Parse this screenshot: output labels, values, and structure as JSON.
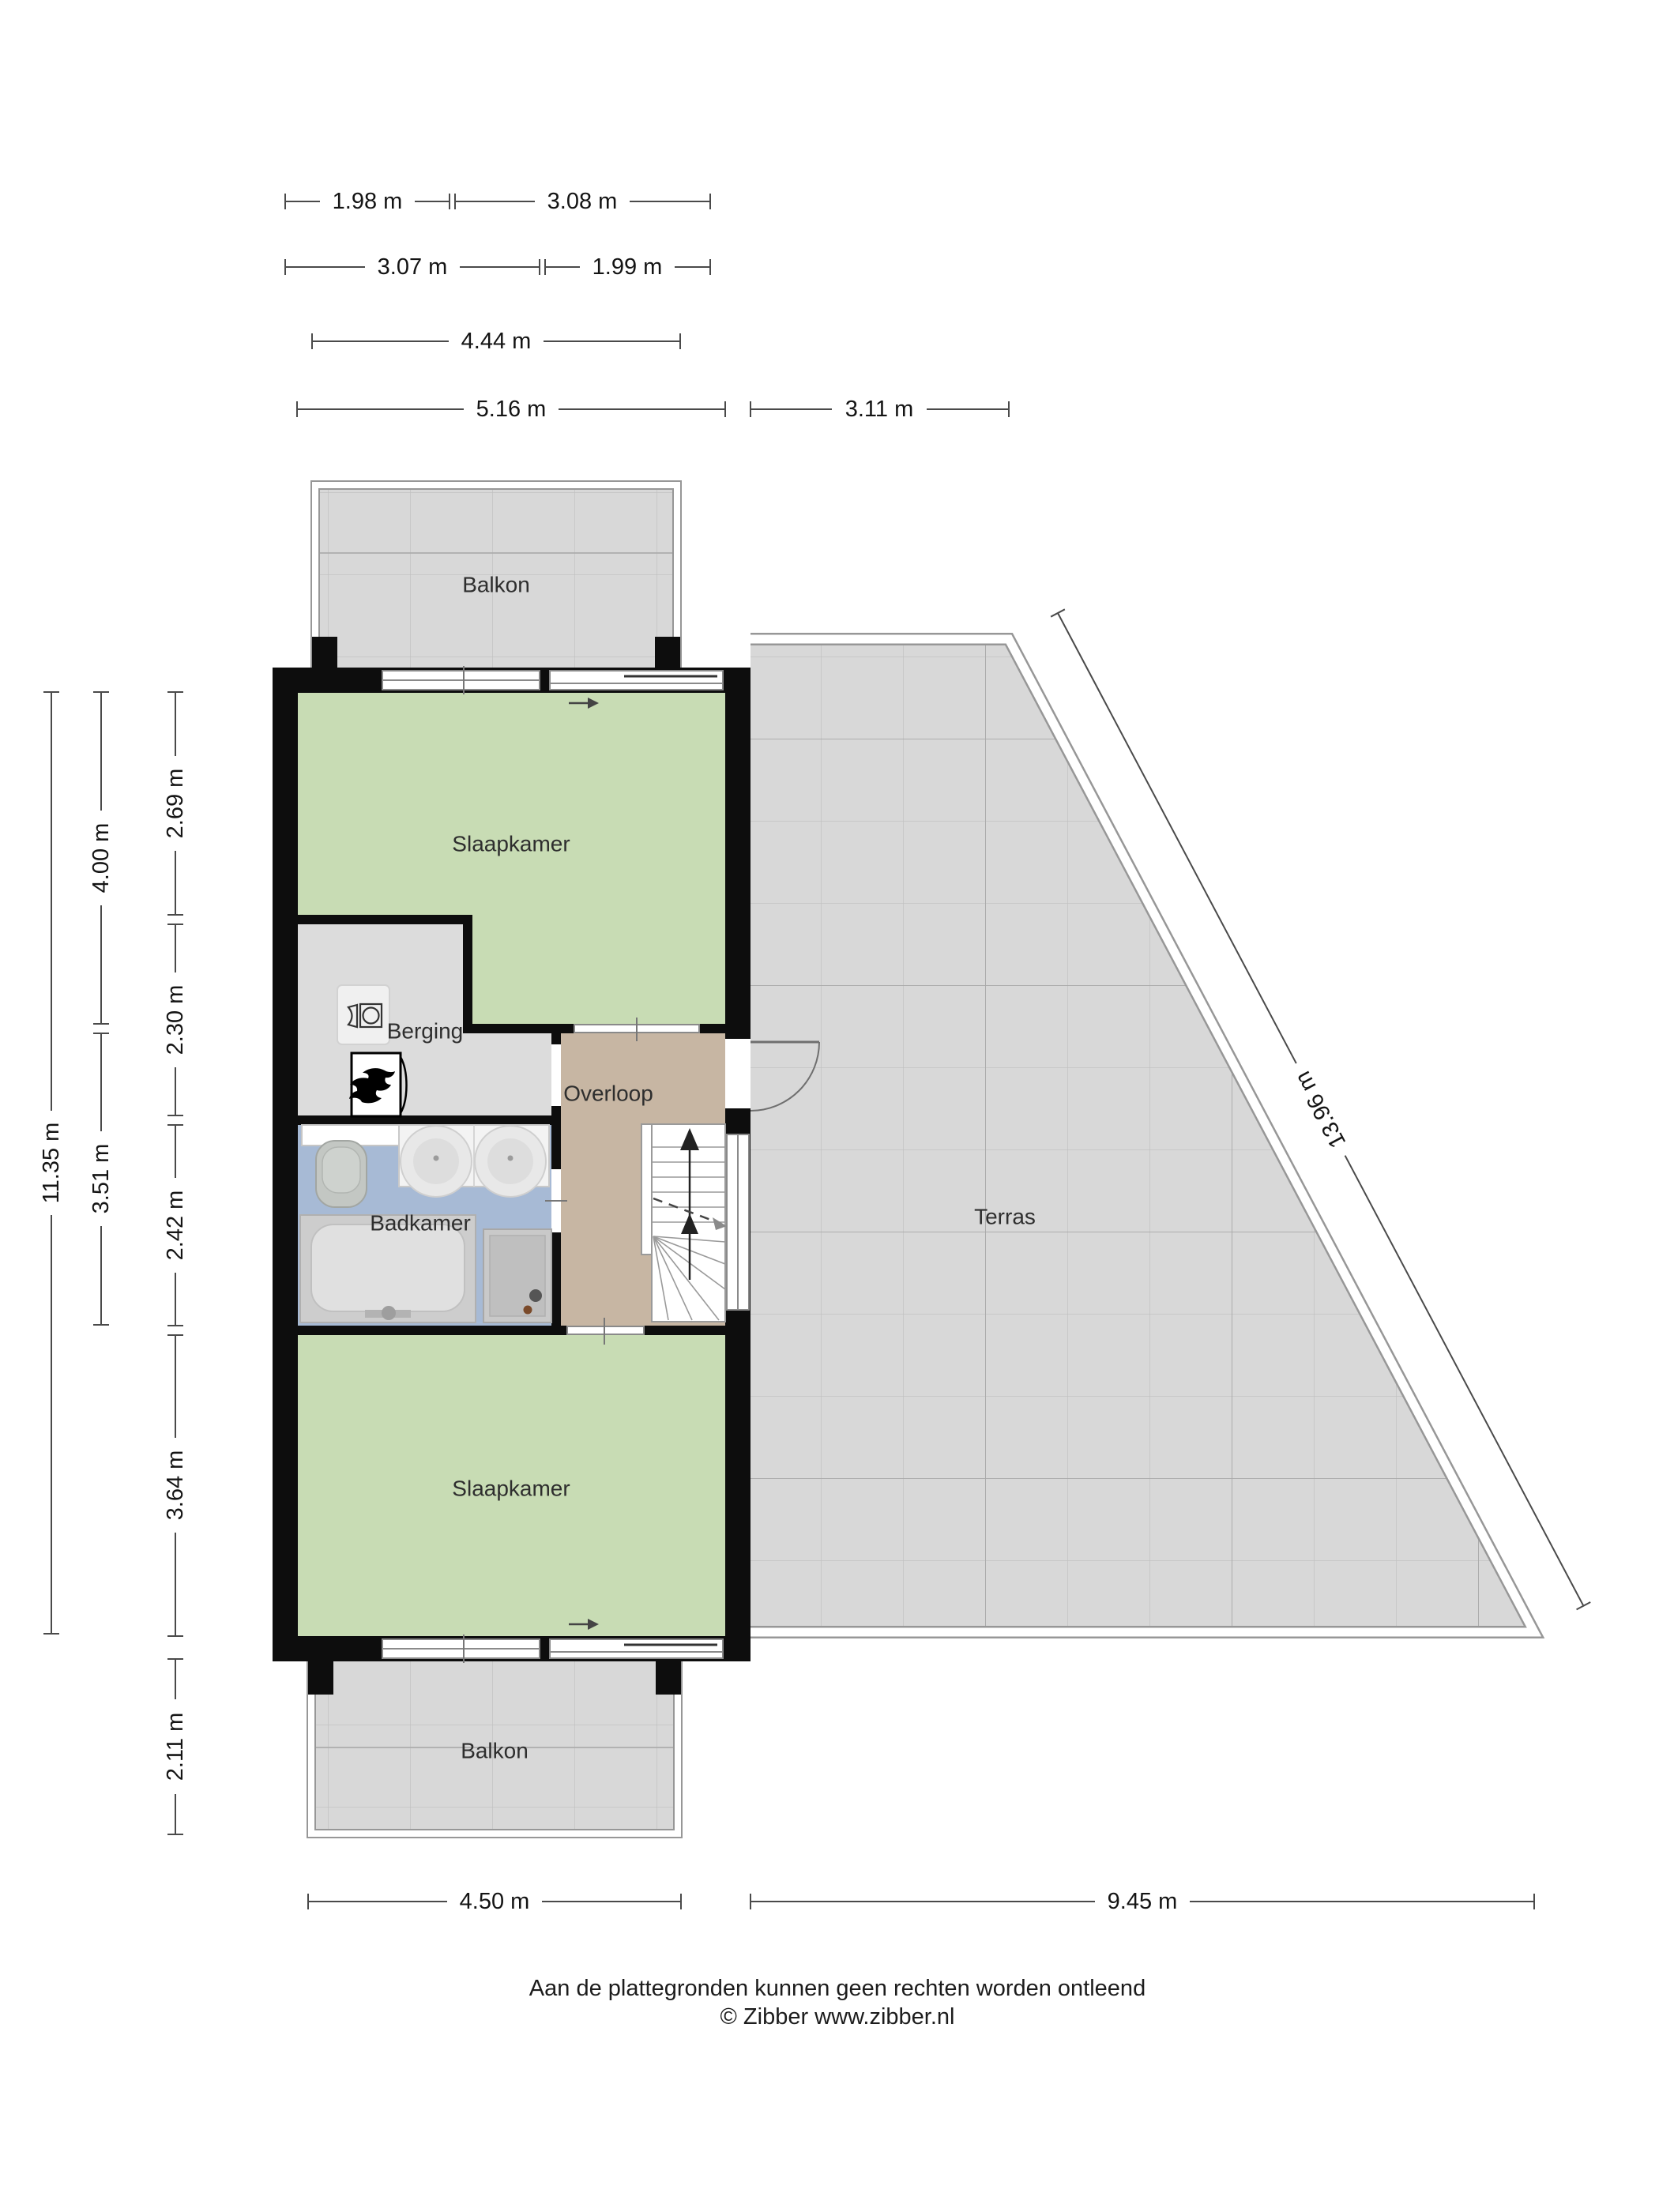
{
  "plan": {
    "type": "floor-plan",
    "floor": "verdieping (upper floor)",
    "language": "Dutch"
  },
  "rooms": {
    "balkon_top": "Balkon",
    "slaapkamer_top": "Slaapkamer",
    "berging": "Berging",
    "overloop": "Overloop",
    "badkamer": "Badkamer",
    "terras": "Terras",
    "slaapkamer_bottom": "Slaapkamer",
    "balkon_bottom": "Balkon"
  },
  "dimensions": {
    "top_row1_left": "1.98 m",
    "top_row1_right": "3.08 m",
    "top_row2_left": "3.07 m",
    "top_row2_right": "1.99 m",
    "top_row3": "4.44 m",
    "top_row4_left": "5.16 m",
    "top_row4_right": "3.11 m",
    "left_total": "11.35 m",
    "left_upper": "4.00 m",
    "left_lower": "3.51 m",
    "left_room1": "2.69 m",
    "left_room2": "2.30 m",
    "left_room3": "2.42 m",
    "left_room4": "3.64 m",
    "left_balkon": "2.11 m",
    "bottom_left": "4.50 m",
    "bottom_right": "9.45 m",
    "diagonal": "13.96 m"
  },
  "footer": {
    "line1": "Aan de plattegronden kunnen geen rechten worden ontleend",
    "line2": "© Zibber www.zibber.nl"
  },
  "icons": {
    "washer": "washing-machine-icon",
    "boiler": "boiler-flame-icon",
    "toilet": "toilet-icon",
    "basins": "double-washbasin-icon",
    "bathtub": "bathtub-icon",
    "shower": "shower-icon",
    "stairs": "staircase-up-icon",
    "door": "door-swing-icon"
  },
  "colors": {
    "wall": "#0d0d0d",
    "room_green": "#c8dcb4",
    "room_blue": "#a7bad5",
    "room_tan": "#c7b6a3",
    "room_gray_light": "#dcdcdc",
    "floor_tile": "#d8d8d8",
    "tile_line": "#c2c2c2",
    "dimension_line": "#4a4a4a",
    "label_text": "#2e2e2e"
  }
}
